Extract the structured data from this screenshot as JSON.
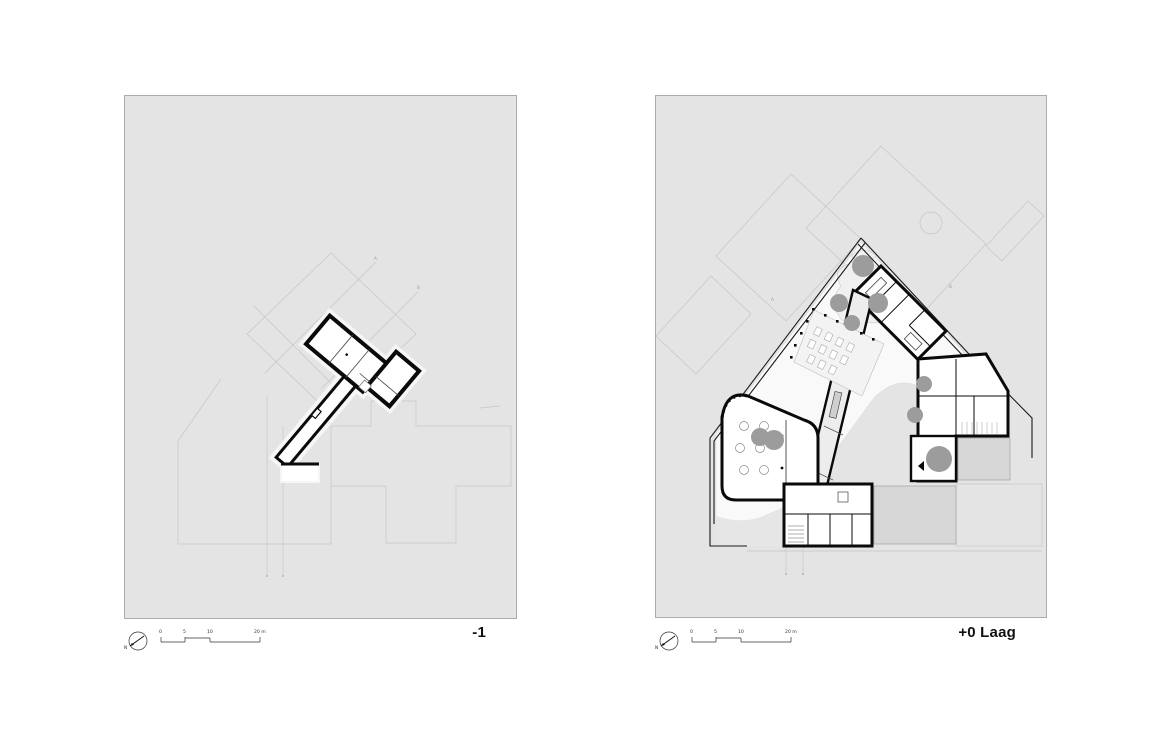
{
  "panels": {
    "left": {
      "title": "-1"
    },
    "right": {
      "title": "+0 Laag"
    }
  },
  "scale_bar": {
    "tick0": "0",
    "tick1": "5",
    "tick2": "10",
    "tick3": "20 m"
  },
  "north": {
    "label": "N"
  },
  "section_markers": {
    "a": "A",
    "b": "B"
  },
  "colors": {
    "paper": "#ffffff",
    "panel_background": "#e4e4e4",
    "panel_border": "#ababab",
    "context_line": "#c6c6c6",
    "wall": "#0a0a0a",
    "tree": "#9c9c9c",
    "plaza": "#d7d7d7",
    "garden": "#f9f9f9"
  }
}
